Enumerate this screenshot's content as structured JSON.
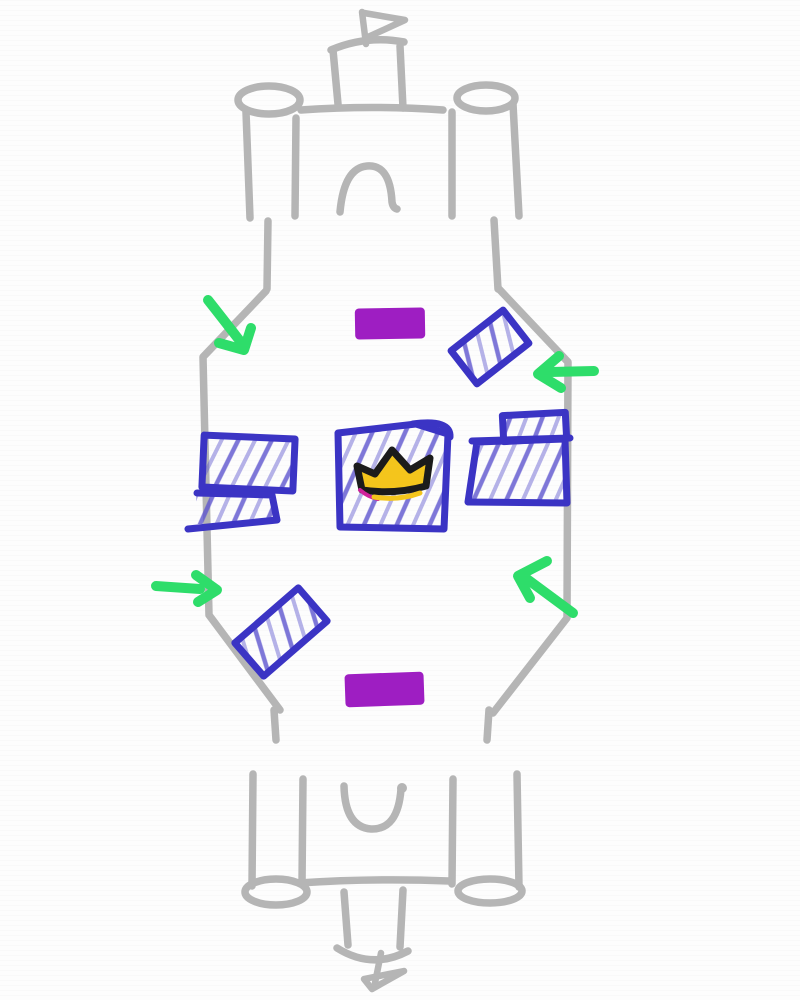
{
  "scene": {
    "kind": "hand-drawn-game-arena-sketch",
    "text_content": "none"
  },
  "colors": {
    "background": "#fdfdfd",
    "sketch_gray": "#b5b5b5",
    "block_blue": "#3b34c4",
    "hatch_blue": "#5d55cf",
    "spawn_purple": "#9e1ec2",
    "arrow_green": "#2edd6a",
    "crown_gold": "#f4c51c",
    "crown_outline": "#1b1b1b",
    "crown_accent_magenta": "#d0219c"
  },
  "elements": [
    {
      "name": "top-castle",
      "kind": "castle-sketch",
      "position": "top-center",
      "color": "sketch_gray",
      "parts": [
        "left-round-tower",
        "flag-tower",
        "pennant-flag",
        "gate-arch",
        "right-round-tower"
      ]
    },
    {
      "name": "bottom-castle",
      "kind": "castle-sketch-mirrored",
      "position": "bottom-center",
      "color": "sketch_gray",
      "parts": [
        "left-round-tower",
        "flag-tower",
        "pennant-flag",
        "gate-arch",
        "right-round-tower"
      ]
    },
    {
      "name": "arena-boundary",
      "kind": "hexagonal-battlefield-outline",
      "color": "sketch_gray",
      "sides": [
        "left",
        "right"
      ]
    },
    {
      "name": "spawn-pad-top",
      "kind": "filled-rectangle",
      "position": "upper-middle",
      "color": "spawn_purple"
    },
    {
      "name": "spawn-pad-bottom",
      "kind": "filled-rectangle",
      "position": "lower-middle",
      "color": "spawn_purple"
    },
    {
      "name": "cover-block-left-upper",
      "kind": "hatched-rectangle",
      "position": "mid-left",
      "color": "block_blue"
    },
    {
      "name": "cover-block-left-lower",
      "kind": "hatched-rectangle-open-left",
      "position": "mid-left-below",
      "color": "block_blue"
    },
    {
      "name": "cover-block-right-upper",
      "kind": "hatched-rectangle",
      "position": "mid-right",
      "color": "block_blue"
    },
    {
      "name": "cover-block-right-lower",
      "kind": "hatched-rectangle",
      "position": "mid-right-below",
      "color": "block_blue"
    },
    {
      "name": "cover-block-top-right-angled",
      "kind": "hatched-rectangle",
      "rotation_deg": -38,
      "position": "upper-right",
      "color": "block_blue"
    },
    {
      "name": "cover-block-bottom-left-angled",
      "kind": "hatched-rectangle",
      "rotation_deg": -41,
      "position": "lower-left",
      "color": "block_blue"
    },
    {
      "name": "center-objective",
      "kind": "hatched-square",
      "position": "center",
      "color": "block_blue",
      "contains": "crown-icon"
    },
    {
      "name": "crown-icon",
      "kind": "three-point-crown",
      "color": "crown_gold",
      "outline": "crown_outline"
    },
    {
      "name": "arrow-top-left",
      "kind": "annotation-arrow",
      "direction": "down-right",
      "color": "arrow_green"
    },
    {
      "name": "arrow-top-right",
      "kind": "annotation-arrow",
      "direction": "left",
      "color": "arrow_green"
    },
    {
      "name": "arrow-mid-left",
      "kind": "annotation-arrow",
      "direction": "right",
      "color": "arrow_green"
    },
    {
      "name": "arrow-bottom-right",
      "kind": "annotation-arrow",
      "direction": "up-left",
      "color": "arrow_green"
    }
  ]
}
